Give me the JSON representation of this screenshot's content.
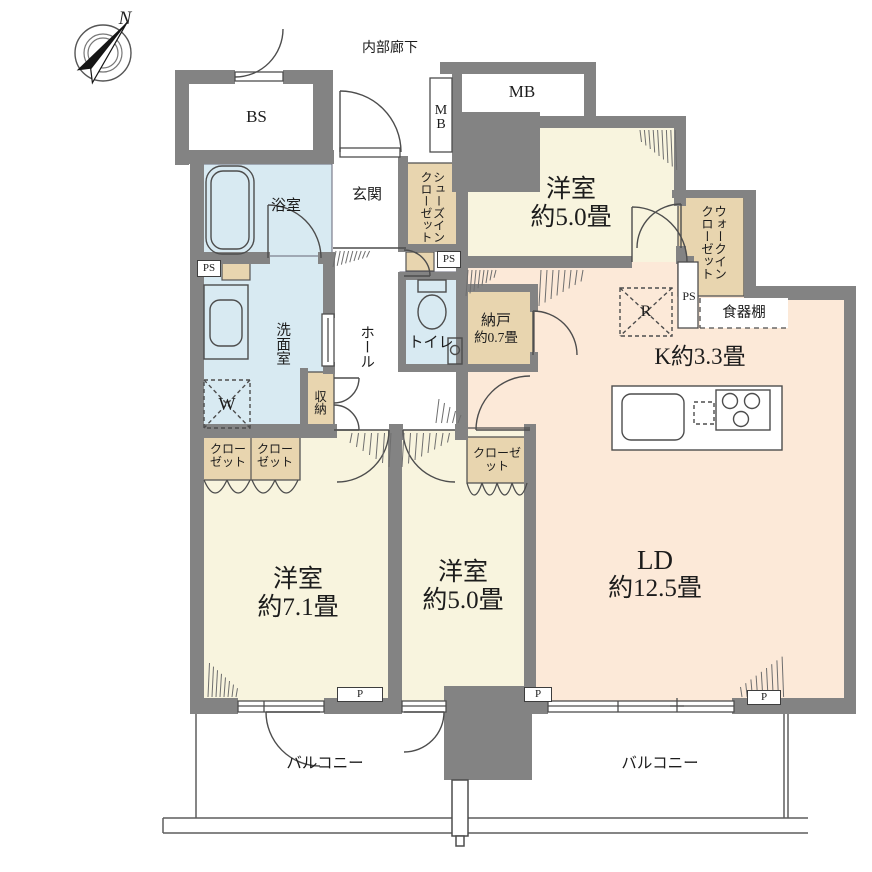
{
  "compass": {
    "north": "N"
  },
  "corridor": {
    "label": "内部廊下"
  },
  "colors": {
    "wall": "#838383",
    "bedroom_cream": "#f8f4de",
    "ldk_pink": "#fce9d8",
    "wet_blue": "#d8eaf2",
    "closet_tan": "#e8d5af",
    "line": "#4d4d4d"
  },
  "rooms": {
    "bs": {
      "label": "BS"
    },
    "mb_duct": {
      "label": "MB"
    },
    "mb": {
      "label": "MB"
    },
    "genkan": {
      "label": "玄関"
    },
    "sic": {
      "label": "シューズインクローゼット"
    },
    "bathroom": {
      "label": "浴室"
    },
    "washroom": {
      "label": "洗面室"
    },
    "toilet": {
      "label": "トイレ"
    },
    "hall": {
      "label": "ホール"
    },
    "storage": {
      "label": "収納"
    },
    "washer": {
      "label": "W"
    },
    "ps_left": {
      "label": "PS"
    },
    "ps_mid": {
      "label": "PS"
    },
    "ps_right": {
      "label": "PS"
    },
    "nando": {
      "name": "納戸",
      "size": "約0.7畳"
    },
    "bedroom3": {
      "name": "洋室",
      "size": "約5.0畳"
    },
    "wic": {
      "label": "ウォークインクローゼット"
    },
    "dish_shelf": {
      "label": "食器棚"
    },
    "kitchen": {
      "label": "K約3.3畳"
    },
    "fridge": {
      "label": "R"
    },
    "ld": {
      "name": "LD",
      "size": "約12.5畳"
    },
    "bedroom1": {
      "name": "洋室",
      "size": "約7.1畳"
    },
    "bedroom2": {
      "name": "洋室",
      "size": "約5.0畳"
    },
    "closet1a": {
      "label": "クローゼット"
    },
    "closet1b": {
      "label": "クローゼット"
    },
    "closet2": {
      "label": "クローゼット"
    },
    "balcony_left": {
      "label": "バルコニー"
    },
    "balcony_right": {
      "label": "バルコニー"
    },
    "pillar1": {
      "label": "P"
    },
    "pillar2": {
      "label": "P"
    },
    "pillar3": {
      "label": "P"
    }
  }
}
